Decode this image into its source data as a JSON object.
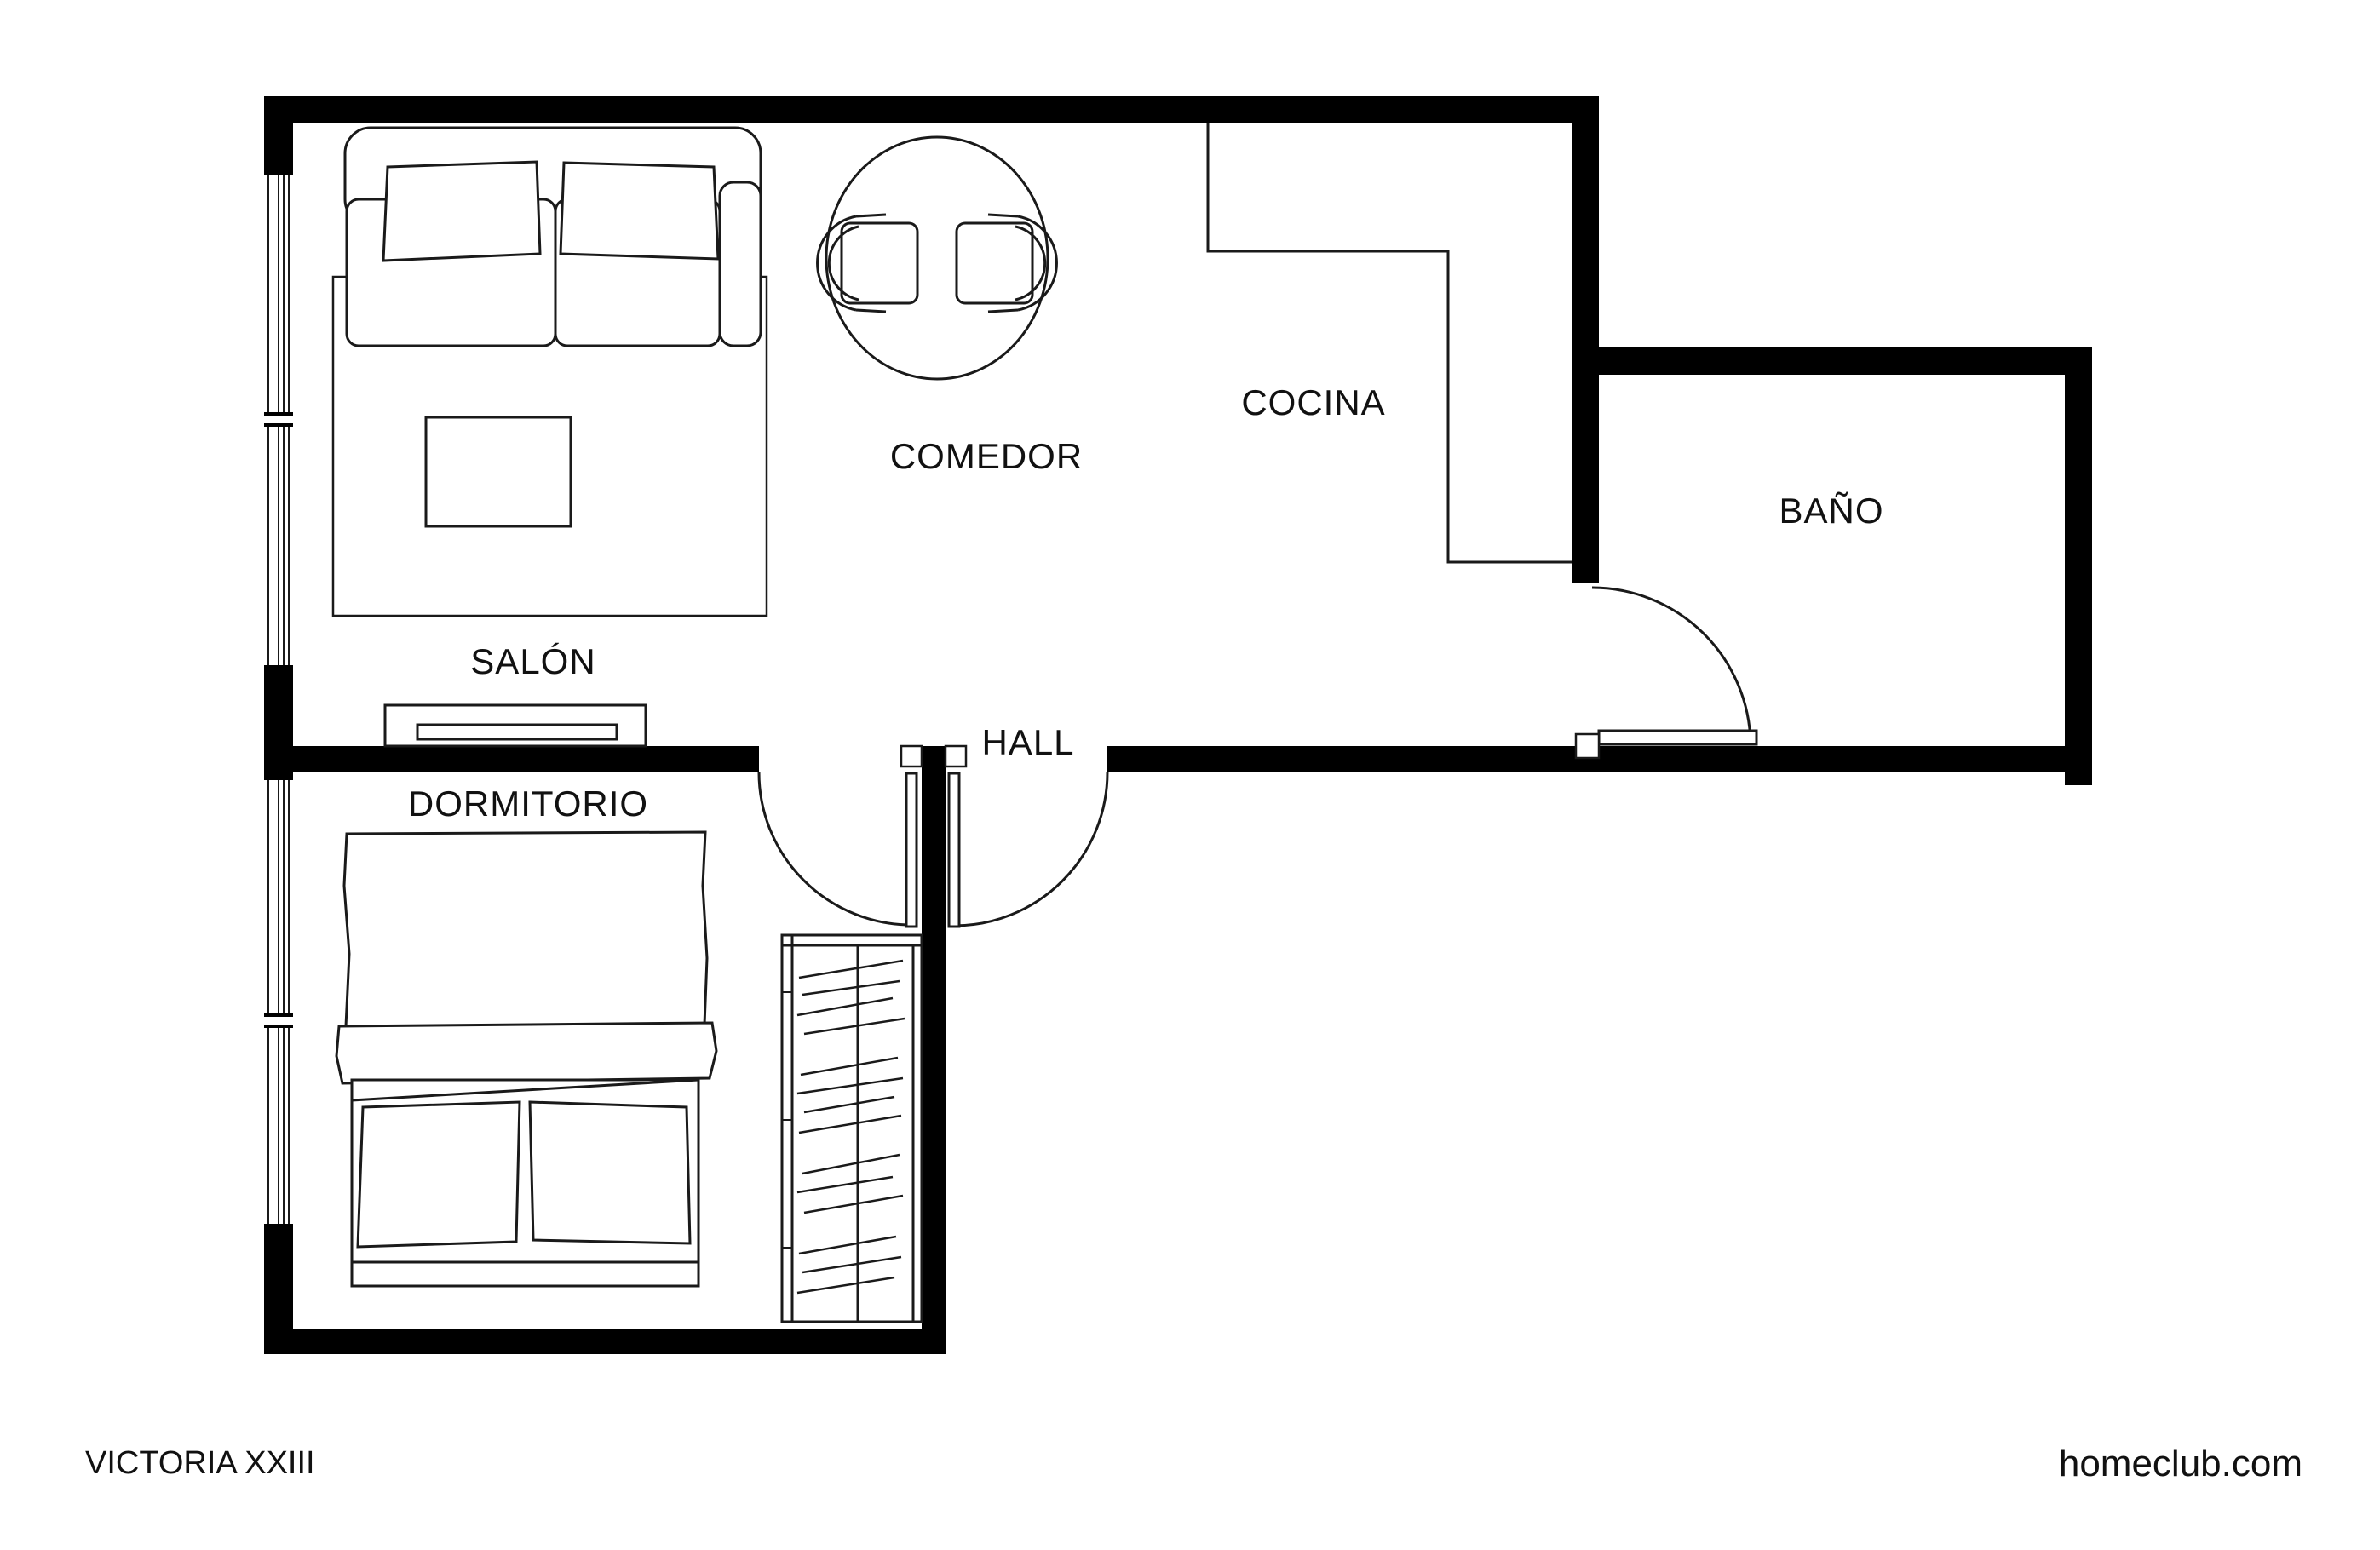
{
  "plan": {
    "type": "apartment-floor-plan",
    "rooms": [
      {
        "id": "salon",
        "label": "SALÓN"
      },
      {
        "id": "comedor",
        "label": "COMEDOR"
      },
      {
        "id": "cocina",
        "label": "COCINA"
      },
      {
        "id": "bano",
        "label": "BAÑO"
      },
      {
        "id": "hall",
        "label": "HALL"
      },
      {
        "id": "dormitorio",
        "label": "DORMITORIO"
      }
    ],
    "furniture": [
      "sofa",
      "rug",
      "coffee-table",
      "tv-unit",
      "dining-table",
      "dining-chairs",
      "bed",
      "pillows",
      "headboard",
      "wardrobe"
    ],
    "openings": [
      "bedroom-door",
      "hall-door",
      "bathroom-door",
      "windows"
    ]
  },
  "footer": {
    "project_name": "VICTORIA XXIII",
    "website": "homeclub.com"
  },
  "colors": {
    "wall": "#000000",
    "line": "#1a1a1a",
    "background": "#ffffff"
  }
}
